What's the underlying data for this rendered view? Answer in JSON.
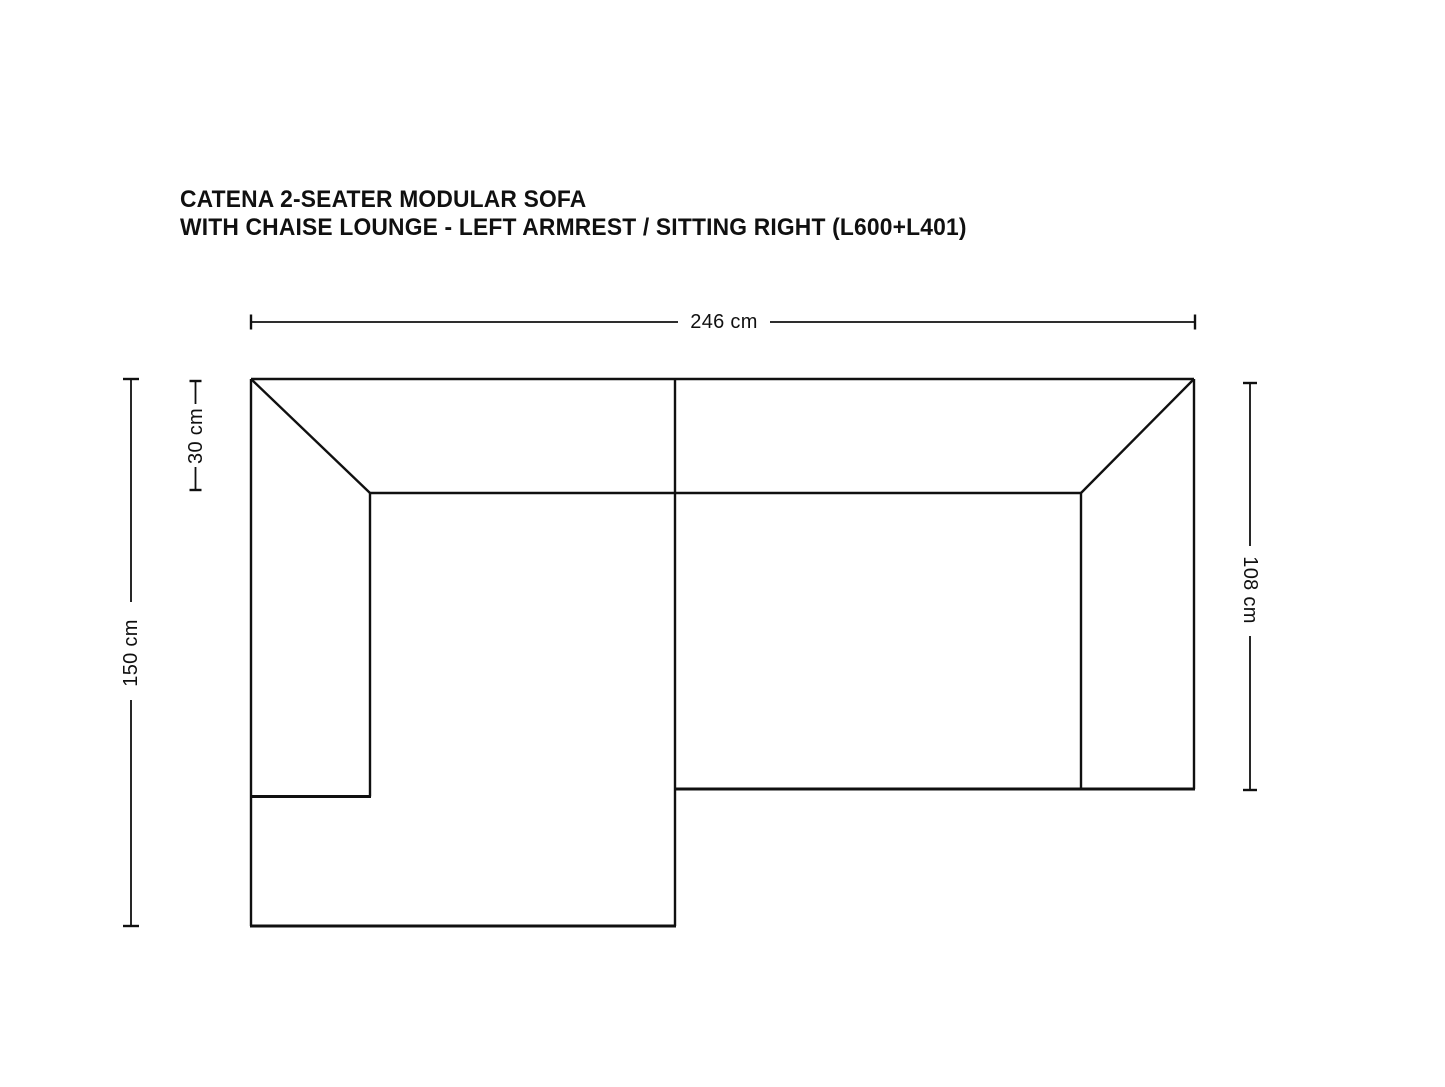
{
  "page": {
    "background_color": "#ffffff",
    "line_color": "#101010"
  },
  "title": {
    "line1": "CATENA 2-SEATER MODULAR SOFA",
    "line2": "WITH CHAISE LOUNGE - LEFT ARMREST / SITTING RIGHT (L600+L401)"
  },
  "dimensions": {
    "total_width": {
      "label": "246 cm"
    },
    "chaise_depth": {
      "label": "150 cm"
    },
    "backrest_depth": {
      "label": "30 cm"
    },
    "seat_depth": {
      "label": "108 cm"
    }
  }
}
